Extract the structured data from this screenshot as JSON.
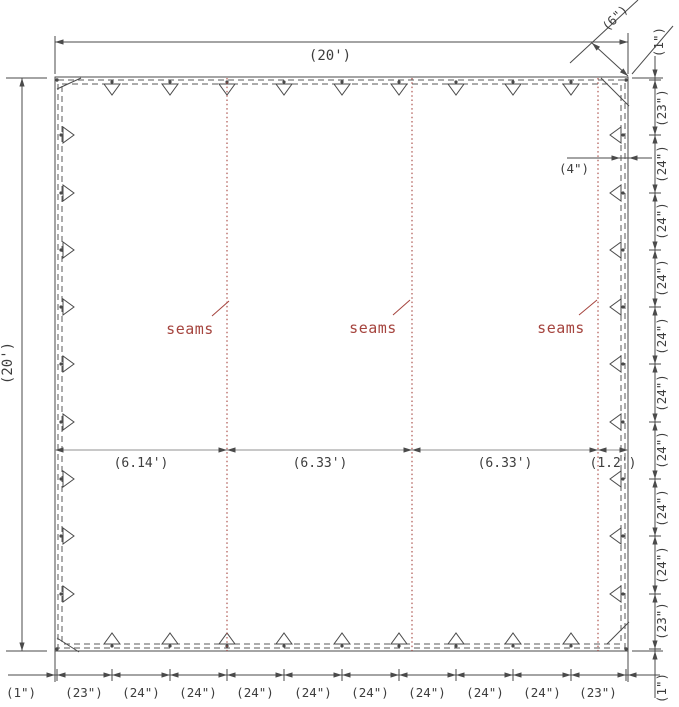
{
  "drawing": {
    "top_width_label": "(20')",
    "left_height_label": "(20')",
    "corner_diagonal_label": "(6\")",
    "hem_width_label": "(4\")",
    "seam_labels": [
      "seams",
      "seams",
      "seams"
    ],
    "panel_widths": [
      "(6.14')",
      "(6.33')",
      "(6.33')",
      "(1.2')"
    ],
    "bottom_spacing": [
      "(1\")",
      "(23\")",
      "(24\")",
      "(24\")",
      "(24\")",
      "(24\")",
      "(24\")",
      "(24\")",
      "(24\")",
      "(24\")",
      "(23\")"
    ],
    "right_spacing": [
      "(1\")",
      "(23\")",
      "(24\")",
      "(24\")",
      "(24\")",
      "(24\")",
      "(24\")",
      "(24\")",
      "(24\")",
      "(24\")",
      "(23\")",
      "(1\")"
    ],
    "colors": {
      "line": "#4a4a4a",
      "seam_red": "#a5443e",
      "mid_line": "#909090",
      "text": "#3d3d3d"
    }
  }
}
